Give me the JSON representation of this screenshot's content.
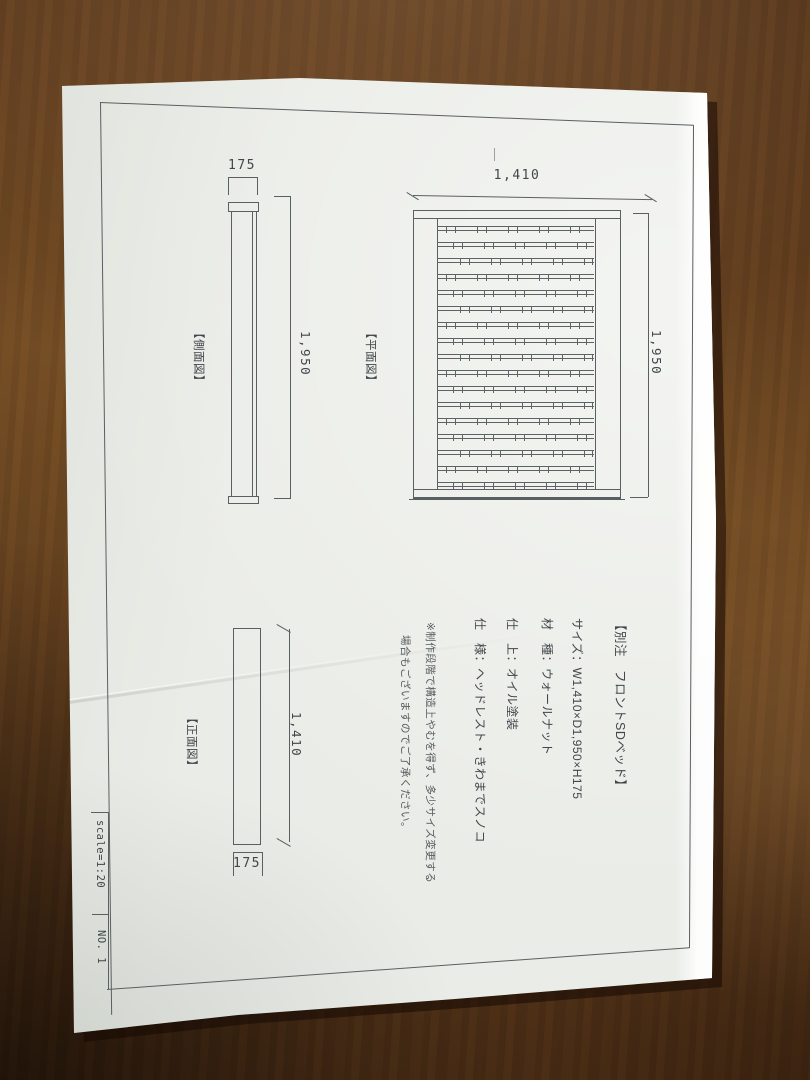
{
  "drawing": {
    "product_title": "【別注　フロントSDベッド】",
    "specs": {
      "size": "サイズ：W1,410×D1,950×H175",
      "material": "材　種：ウォールナット",
      "finish": "仕　上：オイル塗装",
      "features": "仕　様：ヘッドレスト・きわまでスノコ"
    },
    "notes": {
      "line1": "※制作段階で構造上やむを得ず、多少サイズ変更する",
      "line2": "場合もございますのでご了承ください。"
    },
    "views": {
      "plan": {
        "label": "【平面図】",
        "width_dim": "1,410",
        "length_dim": "1,950",
        "slat_count": 17
      },
      "side": {
        "label": "【側面図】",
        "height_dim": "175",
        "length_dim": "1,950"
      },
      "front": {
        "label": "【正面図】",
        "width_dim": "1,410",
        "height_dim": "175"
      }
    },
    "sheet": {
      "scale": "scale=1:20",
      "number": "NO. 1"
    },
    "colors": {
      "paper": "#eaece7",
      "wood": "#63401f",
      "line": "#5a5f62",
      "text": "#41464a"
    }
  }
}
